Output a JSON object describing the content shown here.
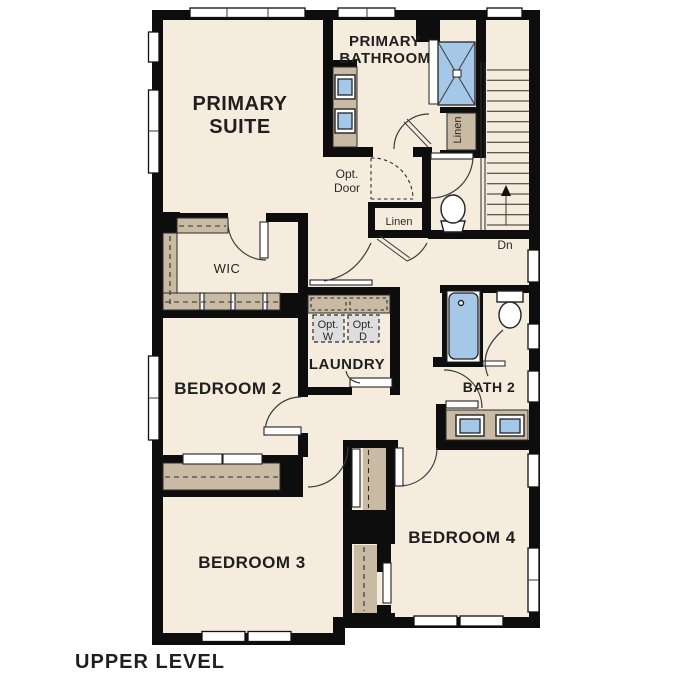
{
  "plan": {
    "title": "UPPER LEVEL",
    "level": "Upper Level floor plan"
  },
  "rooms": {
    "primary_suite": {
      "label_lines": [
        "PRIMARY",
        "SUITE"
      ]
    },
    "primary_bathroom": {
      "label_lines": [
        "PRIMARY",
        "BATHROOM"
      ]
    },
    "wic": {
      "label": "WIC"
    },
    "laundry": {
      "label": "LAUNDRY"
    },
    "bedroom2": {
      "label": "BEDROOM 2"
    },
    "bath2": {
      "label": "BATH 2"
    },
    "bedroom3": {
      "label": "BEDROOM 3"
    },
    "bedroom4": {
      "label": "BEDROOM 4"
    }
  },
  "annotations": {
    "opt_door": {
      "lines": [
        "Opt.",
        "Door"
      ]
    },
    "linen_upper": {
      "label": "Linen"
    },
    "linen_hall": {
      "label": "Linen"
    },
    "opt_washer": {
      "lines": [
        "Opt.",
        "W"
      ]
    },
    "opt_dryer": {
      "lines": [
        "Opt.",
        "D"
      ]
    },
    "stairs_down": {
      "label": "Dn"
    }
  },
  "colors": {
    "floor": "#f5ecde",
    "walls": "#0d0d0d",
    "cabinetry_tan": "#c9bba3",
    "fixture_blue": "#a6c8e8",
    "optional_gray": "#dedede",
    "text": "#1f1f1f"
  }
}
